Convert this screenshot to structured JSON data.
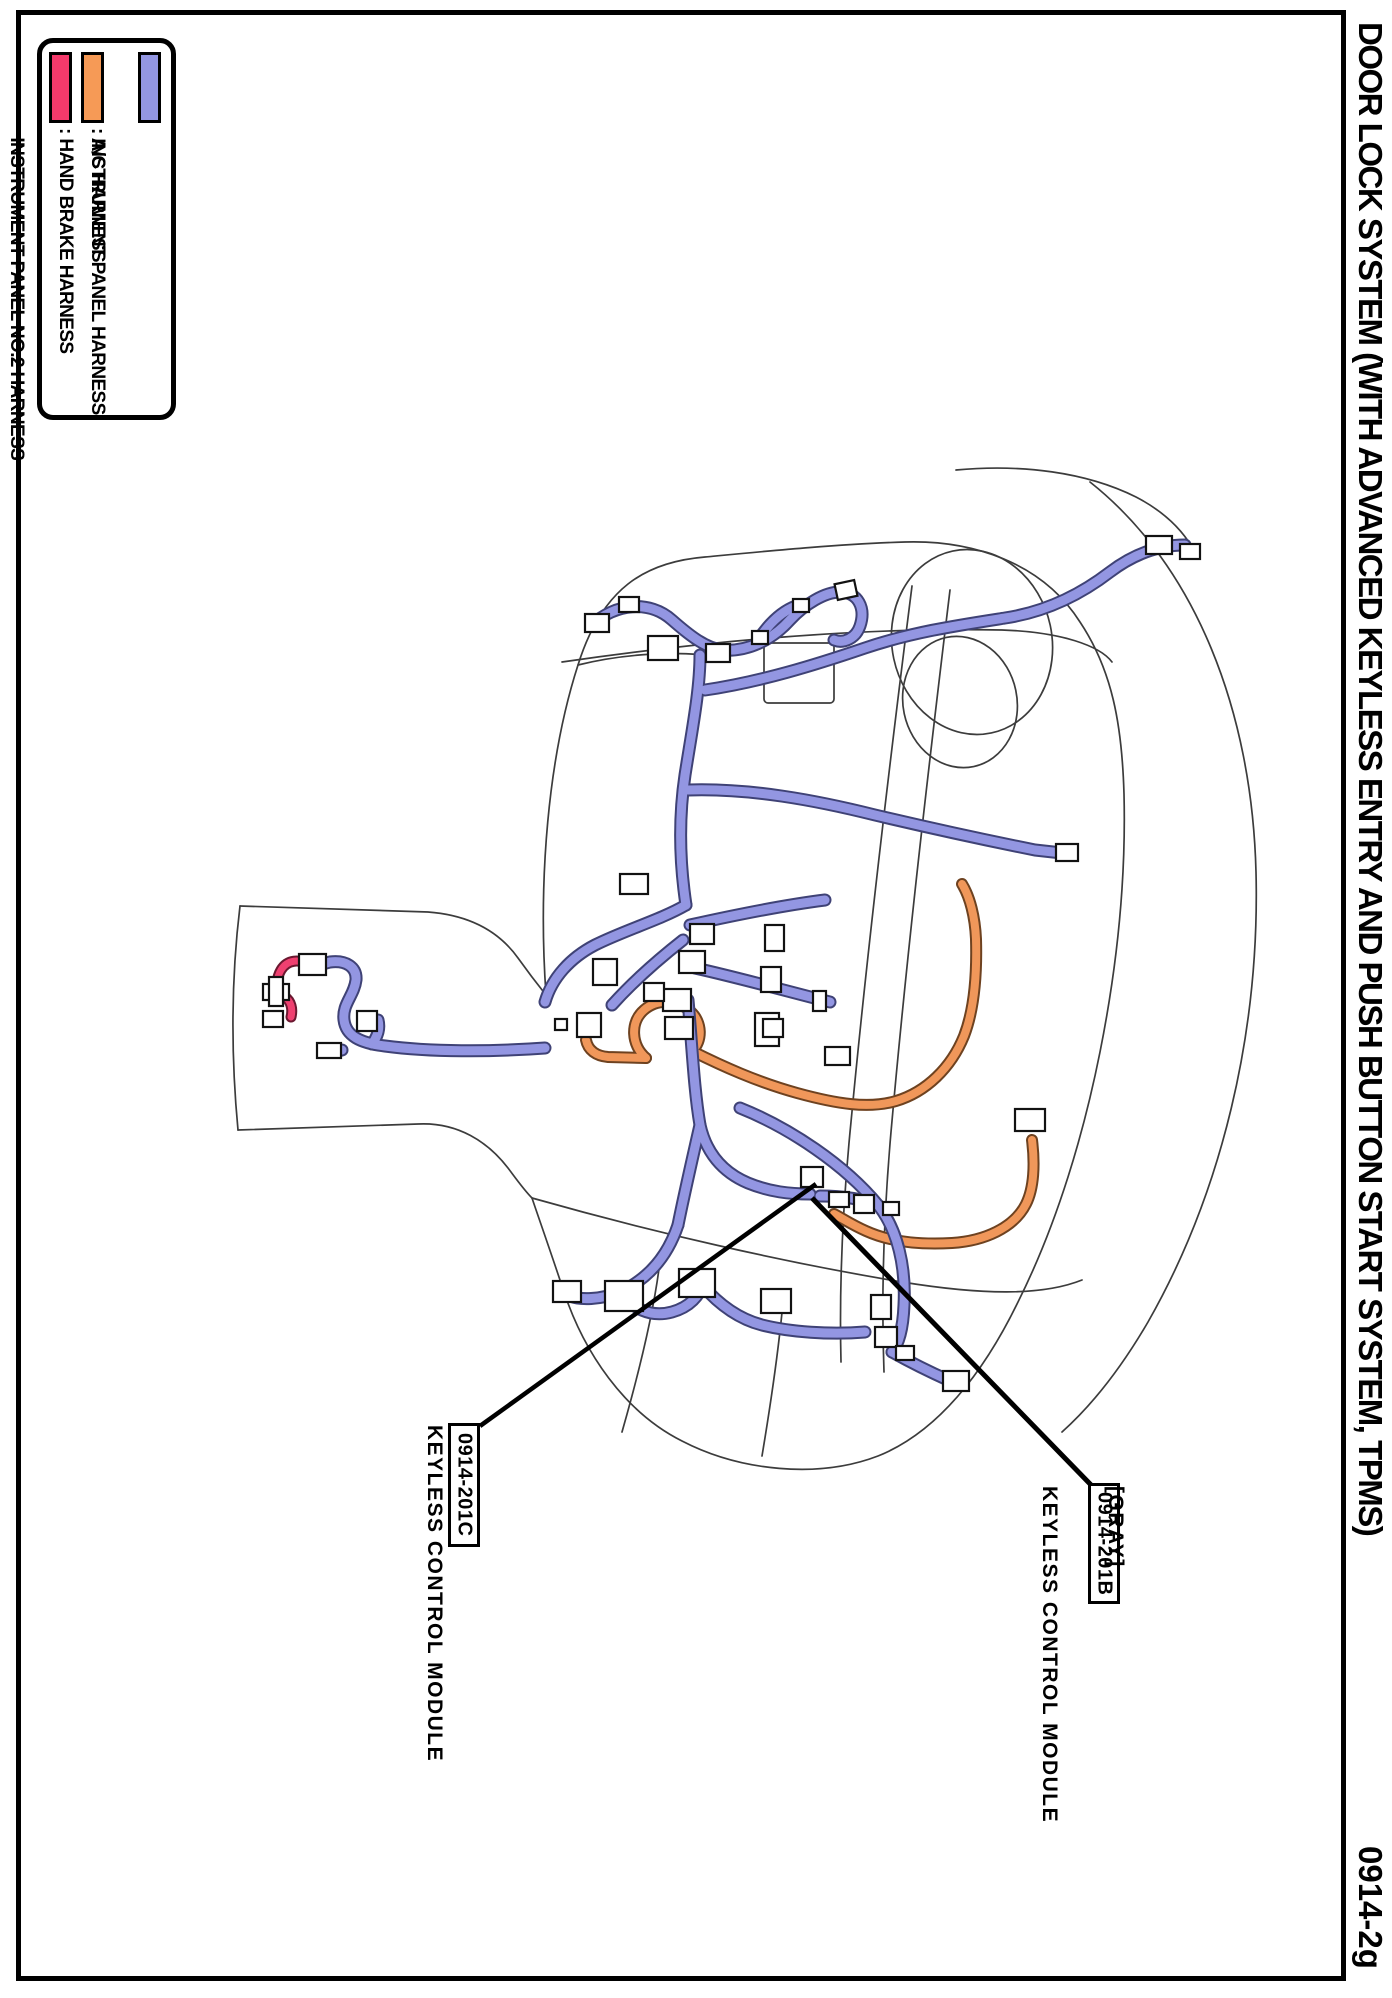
{
  "page": {
    "title": "DOOR LOCK SYSTEM (WITH ADVANCED KEYLESS ENTRY AND PUSH BUTTON START SYSTEM, TPMS)",
    "page_code": "0914-2g"
  },
  "legend": {
    "items": [
      {
        "name": "instrument-panel-harness",
        "color": "#9396E2",
        "lines": [
          ": INSTRUMENT PANEL HARNESS",
          "  INSTRUMENT PANEL NO.2 HARNESS"
        ]
      },
      {
        "name": "ac-harness",
        "color": "#F69A56",
        "lines": [
          ": A/C HARNESS"
        ]
      },
      {
        "name": "hand-brake-harness",
        "color": "#F43A6B",
        "lines": [
          ": HAND BRAKE HARNESS"
        ]
      }
    ]
  },
  "callouts": {
    "left": {
      "code": "0914-201C",
      "label": "KEYLESS CONTROL MODULE"
    },
    "right": {
      "note": "[GRAY]",
      "label": "KEYLESS CONTROL MODULE",
      "code": "0914-201B"
    }
  },
  "diagram": {
    "harness_colors": {
      "instrument_panel": "#9396E2",
      "ac": "#F0975A",
      "hand_brake": "#EF4070",
      "outline": "#3C3C3C"
    }
  }
}
